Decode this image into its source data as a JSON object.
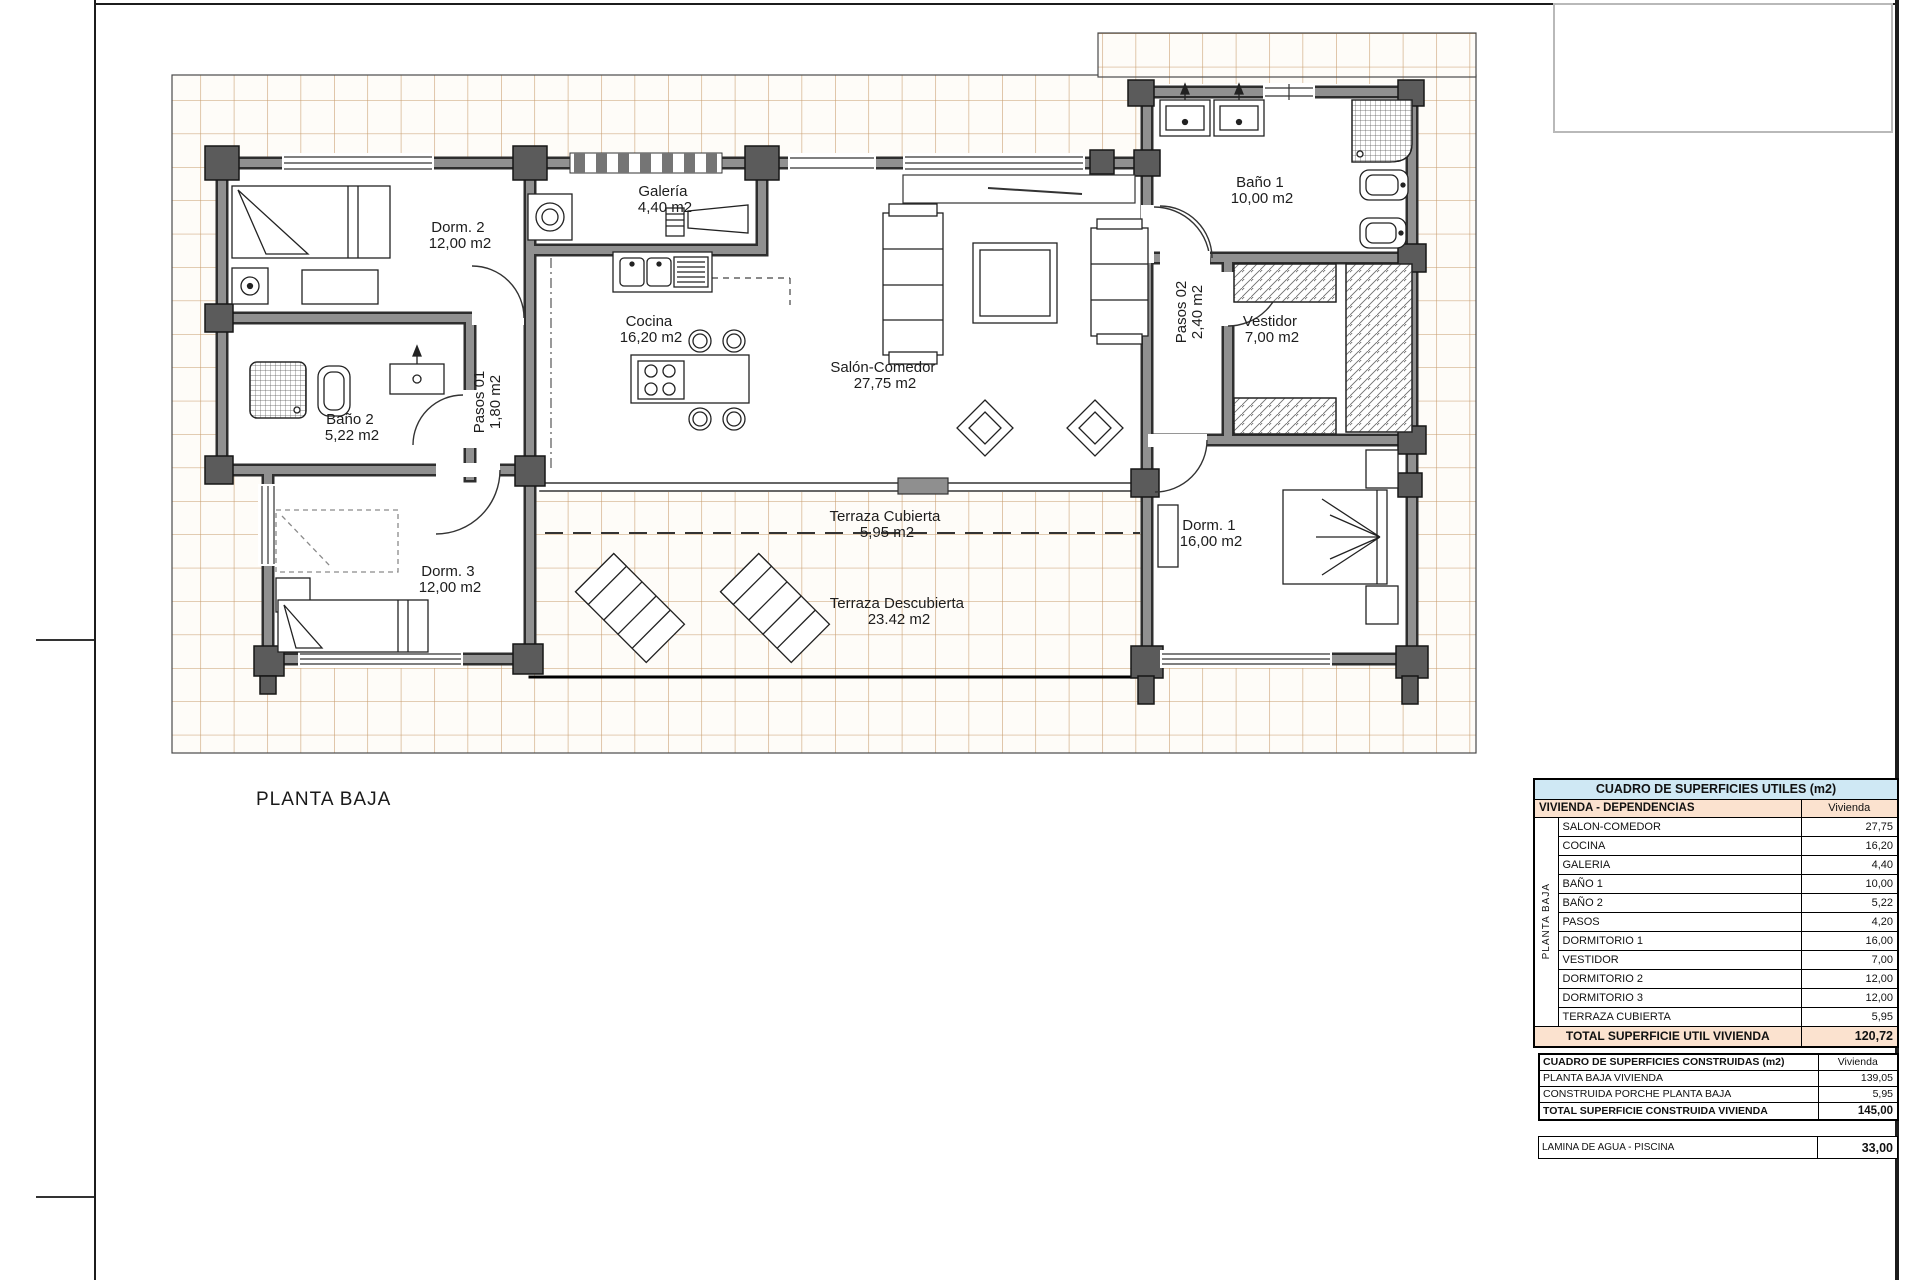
{
  "page": {
    "plan_title": "PLANTA BAJA"
  },
  "plan": {
    "rooms": [
      {
        "id": "dorm2",
        "label": "Dorm. 2",
        "area": "12,00 m2"
      },
      {
        "id": "galeria",
        "label": "Galería",
        "area": "4,40 m2"
      },
      {
        "id": "cocina",
        "label": "Cocina",
        "area": "16,20 m2"
      },
      {
        "id": "salon-comedor",
        "label": "Salón-Comedor",
        "area": "27,75 m2"
      },
      {
        "id": "bano1",
        "label": "Baño 1",
        "area": "10,00 m2"
      },
      {
        "id": "pasos02",
        "label": "Pasos 02",
        "area": "2,40 m2"
      },
      {
        "id": "vestidor",
        "label": "Vestidor",
        "area": "7,00 m2"
      },
      {
        "id": "bano2",
        "label": "Baño 2",
        "area": "5,22 m2"
      },
      {
        "id": "pasos01",
        "label": "Pasos 01",
        "area": "1,80 m2"
      },
      {
        "id": "dorm3",
        "label": "Dorm. 3",
        "area": "12,00 m2"
      },
      {
        "id": "terraza-cubierta",
        "label": "Terraza Cubierta",
        "area": "5,95 m2"
      },
      {
        "id": "terraza-descubierta",
        "label": "Terraza Descubierta",
        "area": "23.42 m2"
      },
      {
        "id": "dorm1",
        "label": "Dorm. 1",
        "area": "16,00 m2"
      }
    ]
  },
  "tables": {
    "utiles": {
      "title": "CUADRO DE SUPERFICIES UTILES (m2)",
      "col_group": "VIVIENDA - DEPENDENCIAS",
      "col_value": "Vivienda",
      "side_label": "PLANTA BAJA",
      "rows": [
        {
          "name": "SALON-COMEDOR",
          "value": "27,75"
        },
        {
          "name": "COCINA",
          "value": "16,20"
        },
        {
          "name": "GALERIA",
          "value": "4,40"
        },
        {
          "name": "BAÑO 1",
          "value": "10,00"
        },
        {
          "name": "BAÑO 2",
          "value": "5,22"
        },
        {
          "name": "PASOS",
          "value": "4,20"
        },
        {
          "name": "DORMITORIO 1",
          "value": "16,00"
        },
        {
          "name": "VESTIDOR",
          "value": "7,00"
        },
        {
          "name": "DORMITORIO 2",
          "value": "12,00"
        },
        {
          "name": "DORMITORIO 3",
          "value": "12,00"
        },
        {
          "name": "TERRAZA CUBIERTA",
          "value": "5,95"
        }
      ],
      "total_label": "TOTAL SUPERFICIE UTIL VIVIENDA",
      "total_value": "120,72"
    },
    "construidas": {
      "title": "CUADRO DE SUPERFICIES CONSTRUIDAS (m2)",
      "col_value": "Vivienda",
      "rows": [
        {
          "name": "PLANTA BAJA VIVIENDA",
          "value": "139,05"
        },
        {
          "name": "CONSTRUIDA PORCHE PLANTA BAJA",
          "value": "5,95"
        }
      ],
      "total_label": "TOTAL SUPERFICIE CONSTRUIDA VIVIENDA",
      "total_value": "145,00"
    },
    "piscina": {
      "name": "LAMINA DE AGUA - PISCINA",
      "value": "33,00"
    }
  },
  "colors": {
    "table_title_bg": "#cfe8f4",
    "table_band_bg": "#fbe2cf",
    "tile_line": "#c79b6c",
    "wall_gray": "#8f8f8f",
    "frame_black": "#1c1c1c"
  }
}
